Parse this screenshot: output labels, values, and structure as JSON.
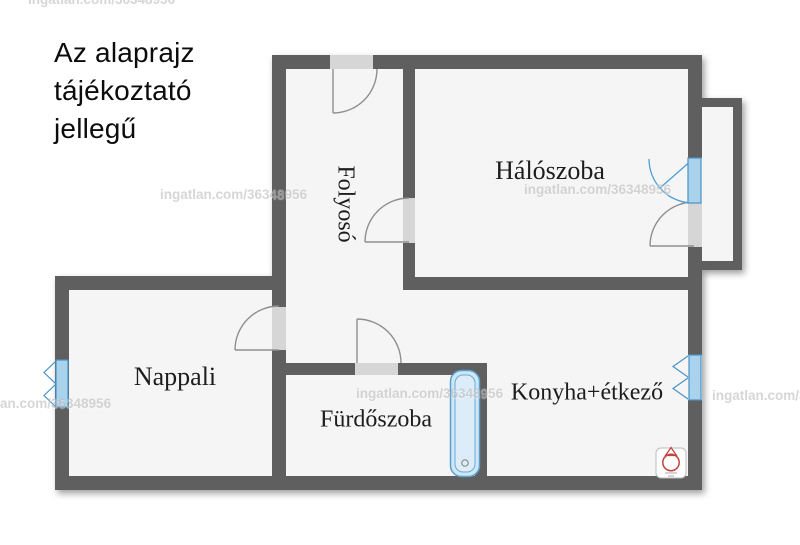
{
  "disclaimer": {
    "line1": "Az alaprajz",
    "line2": "tájékoztató",
    "line3": "jellegű"
  },
  "watermark": {
    "text": "ingatlan.com/36348956"
  },
  "rooms": {
    "folyoso": {
      "label": "Folyosó"
    },
    "haloszoba": {
      "label": "Hálószoba"
    },
    "nappali": {
      "label": "Nappali"
    },
    "furdoszoba": {
      "label": "Fürdőszoba"
    },
    "konyha": {
      "label": "Konyha+étkező"
    }
  },
  "fixtures": {
    "bathtub_icon": "bathtub",
    "boiler_icon": "gas-boiler",
    "window_icon": "casement-window",
    "door_icon": "door-swing-arc",
    "balcony_door_icon": "glazed-balcony-door"
  },
  "colors": {
    "wall": "#5e5e5e",
    "room_fill": "#f5f5f6",
    "threshold": "#d6d6d6",
    "door_arc": "#8f8f8f",
    "window_stroke": "#4a92c6",
    "window_fill": "#a9d2ec",
    "bathtub_fill": "#cfe6f4",
    "boiler_red": "#c2443a",
    "label_text": "#1d1d1d",
    "watermark_gray": "#bdbdbd"
  }
}
